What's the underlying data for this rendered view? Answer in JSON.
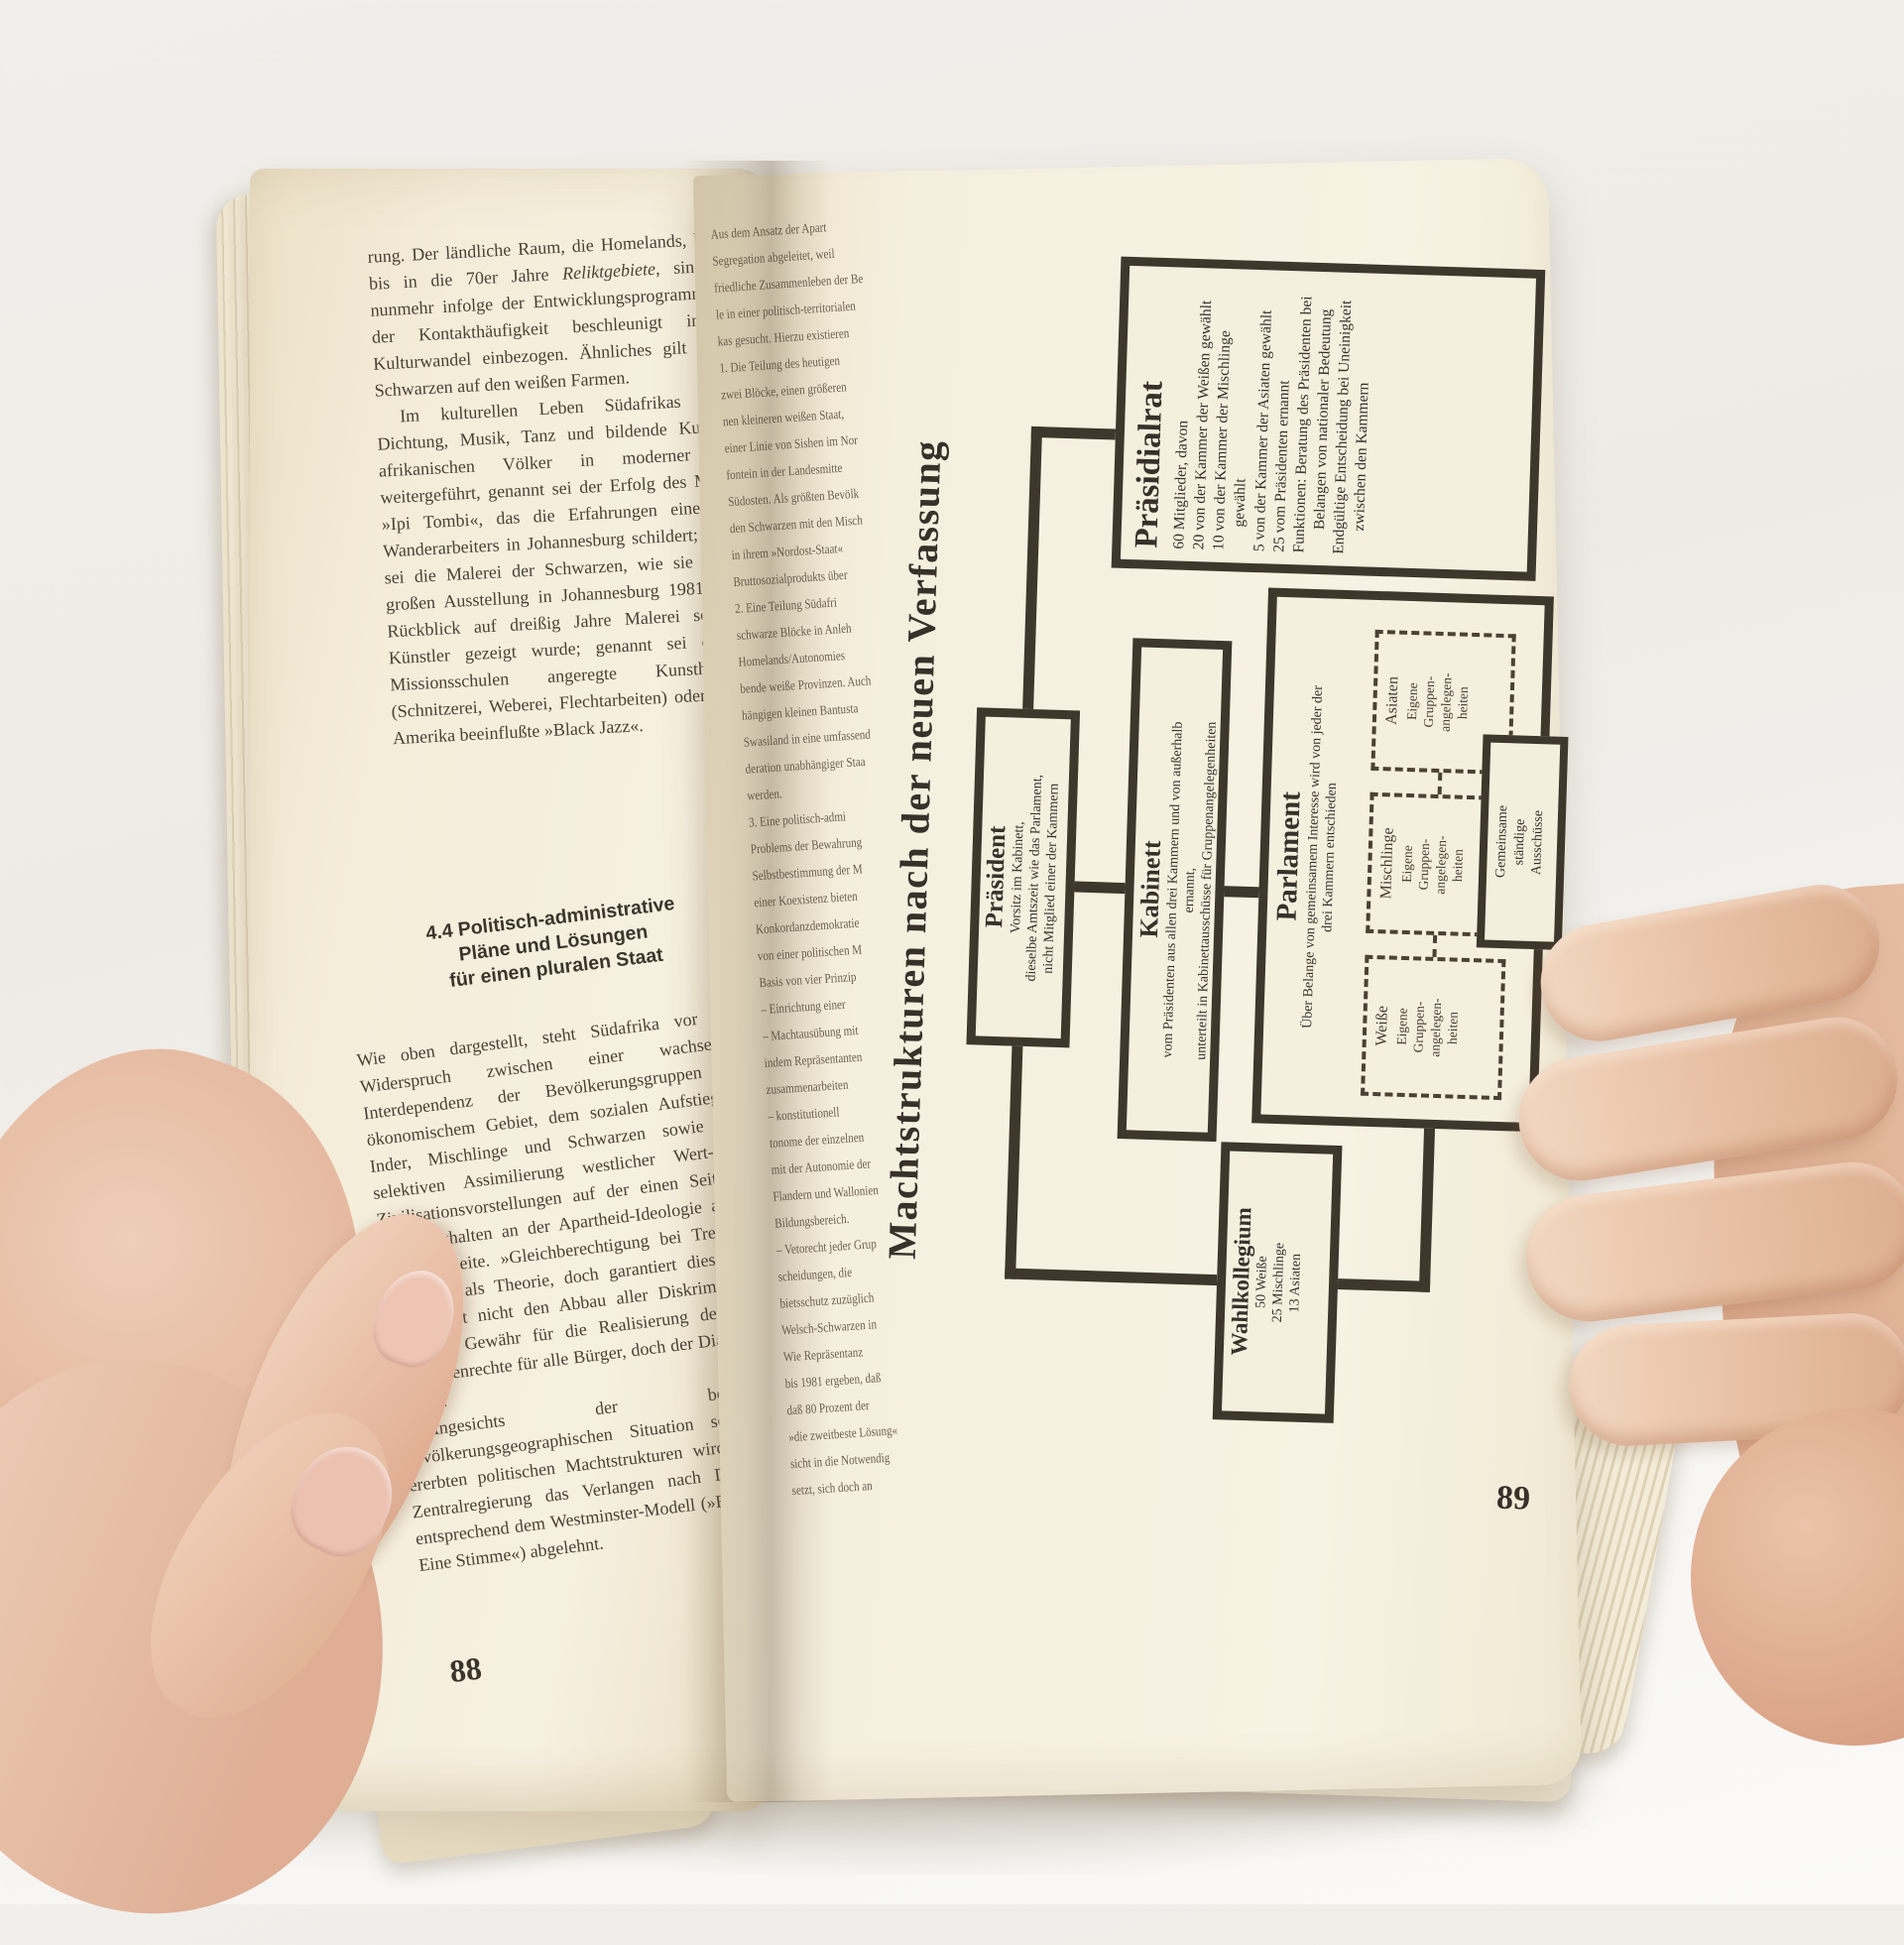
{
  "colors": {
    "backdrop": "#f1efeb",
    "page_cream": "#f5efde",
    "ink": "#4a4135",
    "diagram_ink": "#38312a",
    "border": "#3e372c",
    "skin": "#eac7ae"
  },
  "left_page": {
    "page_number": "88",
    "p1_pre": "rung. Der ländliche Raum, die Homelands, blieben bis in die 70er Jahre ",
    "p1_italic": "Reliktgebiete",
    "p1_post": ", sind aber nunmehr infolge der Entwicklungsprogramme und der Kontakthäufigkeit beschleunigt in den Kulturwandel einbezogen. Ähnliches gilt für die Schwarzen auf den weißen Farmen.",
    "p2": "Im kulturellen Leben Südafrikas werden Dichtung, Musik, Tanz und bildende Kunst der afrikanischen Völker in moderner Form weitergeführt, genannt sei der Erfolg des Musicals »Ipi Tombi«, das die Erfahrungen eines Zulu-Wanderarbeiters in Johannesburg schildert; genannt sei die Malerei der Schwarzen, wie sie in einer großen Ausstellung in Johannesburg 1981 als ein Rückblick auf dreißig Jahre Malerei schwarzer Künstler gezeigt wurde; genannt sei das von Missionsschulen angeregte Kunsthandwerk (Schnitzerei, Weberei, Flechtarbeiten) oder der von Amerika beeinflußte »Black Jazz«.",
    "heading_lines": [
      "4.4  Politisch-administrative",
      "Pläne und Lösungen",
      "für einen pluralen Staat"
    ],
    "p3": "Wie oben dargestellt, steht Südafrika vor dem Widerspruch zwischen einer wachsenden Interdependenz der Bevölkerungsgruppen auf ökonomischem Gebiet, dem sozialen Aufstieg der Inder, Mischlinge und Schwarzen sowie einer selektiven Assimilierung westlicher Wert- und Zivilisationsvorstellungen auf der einen Seite und dem Festhalten an der Apartheid-Ideologie auf der anderen Seite. »Gleichberechtigung bei Trennung« gilt zwar als Theorie, doch garantiert dies in der Gegenwart nicht den Abbau aller Diskriminierung und die Gewähr für die Realisierung der UNO-Menschenrechte für alle Bürger, doch der Dialog geht weiter.",
    "p4": "Angesichts der besonderen bevölkerungsgeographischen Situation sowie der ererbten politischen Machtstrukturen wird von der Zentralregierung das Verlangen nach Demokratie entsprechend dem Westminster-Modell (»Ein Mann – Eine Stimme«) abgelehnt."
  },
  "right_page": {
    "page_number": "89",
    "gutter_lines": [
      "Aus dem Ansatz der Apart",
      "Segregation abgeleitet, weil",
      "friedliche Zusammenleben der Be",
      "le in einer politisch-territorialen",
      "kas gesucht. Hierzu existieren",
      "1. Die Teilung des heutigen",
      "zwei Blöcke, einen größeren",
      "nen kleineren weißen Staat,",
      "einer Linie von Sishen im Nor",
      "fontein in der Landesmitte",
      "Südosten. Als größten Bevölk",
      "den Schwarzen mit den Misch",
      "in ihrem »Nordost-Staat«",
      "Bruttosozialprodukts über",
      "2. Eine Teilung Südafri",
      "schwarze Blöcke in Anleh",
      "Homelands/Autonomies",
      "bende weiße Provinzen. Auch",
      "hängigen kleinen Bantusta",
      "Swasiland in eine umfassend",
      "deration unabhängiger Staa",
      "werden.",
      "3. Eine politisch-admi",
      "Problems der Bewahrung",
      "Selbstbestimmung der M",
      "einer Koexistenz bieten",
      "Konkordanzdemokratie",
      "von einer politischen M",
      "Basis von vier Prinzip",
      "– Einrichtung einer",
      "– Machtausübung mit",
      "indem Repräsentanten",
      "zusammenarbeiten",
      "– konstitutionell",
      "tonome der einzelnen",
      "mit der Autonomie der",
      "Flandern und Wallonien",
      "Bildungsbereich.",
      "– Vetorecht jeder Grup",
      "scheidungen, die",
      "bietsschutz zuzüglich",
      "Welsch-Schwarzen in",
      "Wie Repräsentanz",
      "bis 1981 ergeben, daß",
      "daß 80 Prozent der",
      "»die zweitbeste Lösung«",
      "sicht in die Notwendig",
      "setzt, sich doch an"
    ],
    "diagram": {
      "title": "Machtstrukturen nach der neuen Verfassung",
      "praesidialrat": {
        "heading": "Präsidialrat",
        "lines": [
          "60 Mitglieder, davon",
          "20 von der Kammer der Weißen gewählt",
          "10 von der Kammer der Mischlinge gewählt",
          "5 von der Kammer der Asiaten gewählt",
          "25 vom Präsidenten ernannt",
          "Funktionen: Beratung des Präsidenten bei Belangen von nationaler Bedeutung",
          "Endgültige Entscheidung bei Uneinigkeit zwischen den Kammern"
        ]
      },
      "praesident": {
        "heading": "Präsident",
        "lines": [
          "Vorsitz im Kabinett,",
          "dieselbe Amtszeit wie das Parlament,",
          "nicht Mitglied einer der Kammern"
        ]
      },
      "kabinett": {
        "heading": "Kabinett",
        "lines": [
          "vom Präsidenten aus allen drei Kammern und von außerhalb",
          "ernannt,",
          "unterteilt in Kabinettausschüsse für Gruppenangelegenheiten"
        ]
      },
      "parlament": {
        "heading": "Parlament",
        "lines": [
          "Über Belange von gemeinsamem Interesse wird von jeder der",
          "drei Kammern entschieden"
        ],
        "chambers": [
          {
            "label": "Weiße",
            "lines": [
              "Eigene",
              "Gruppen-",
              "angelegen-",
              "heiten"
            ]
          },
          {
            "label": "Mischlinge",
            "lines": [
              "Eigene",
              "Gruppen-",
              "angelegen-",
              "heiten"
            ]
          },
          {
            "label": "Asiaten",
            "lines": [
              "Eigene",
              "Gruppen-",
              "angelegen-",
              "heiten"
            ]
          }
        ],
        "committee_lines": [
          "Gemeinsame",
          "ständige",
          "Ausschüsse"
        ]
      },
      "wahlkollegium": {
        "heading": "Wahlkollegium",
        "lines": [
          "50 Weiße",
          "25 Mischlinge",
          "13 Asiaten"
        ]
      }
    }
  }
}
